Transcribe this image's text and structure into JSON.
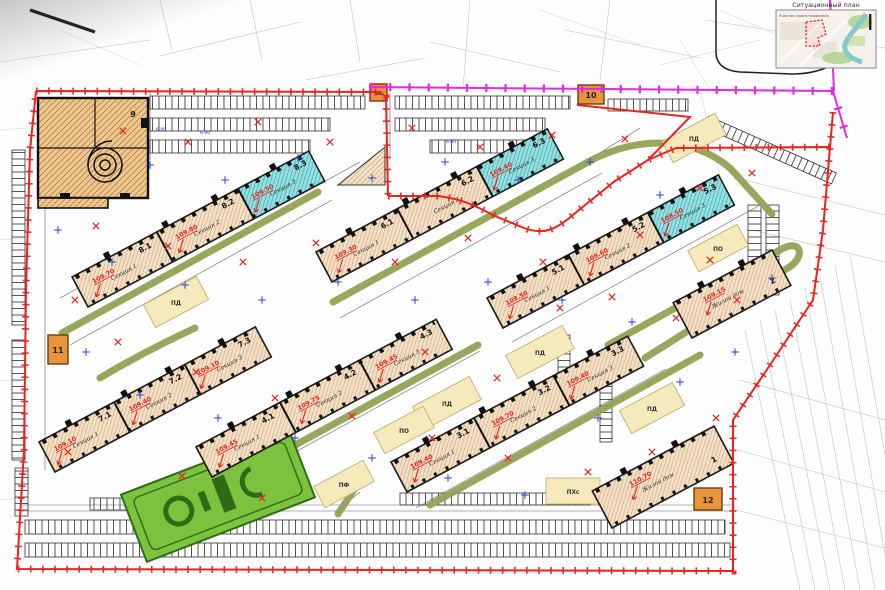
{
  "inset": {
    "title": "Ситуационный план",
    "caption": "Участок проектирования"
  },
  "buildings": [
    {
      "id": "8",
      "sections": [
        {
          "num": "8.1",
          "name": "Секция 1",
          "elev": "109.70"
        },
        {
          "num": "8.2",
          "name": "Секция 2",
          "elev": "109.80"
        },
        {
          "num": "8.3",
          "name": "Секция 3",
          "elev": "109.50"
        }
      ]
    },
    {
      "id": "6",
      "sections": [
        {
          "num": "6.1",
          "name": "Секция 1",
          "elev": "109.30"
        },
        {
          "num": "6.2",
          "name": "Секция 2",
          "elev": ""
        },
        {
          "num": "6.3",
          "name": "Секция 3",
          "elev": "109.40"
        }
      ]
    },
    {
      "id": "5",
      "sections": [
        {
          "num": "5.1",
          "name": "Секция 1",
          "elev": "109.50"
        },
        {
          "num": "5.2",
          "name": "Секция 2",
          "elev": "109.60"
        },
        {
          "num": "5.3",
          "name": "Секция 3",
          "elev": "109.50"
        }
      ]
    },
    {
      "id": "7",
      "sections": [
        {
          "num": "7.1",
          "name": "Секция 1",
          "elev": "109.10"
        },
        {
          "num": "7.2",
          "name": "Секция 2",
          "elev": "109.40"
        },
        {
          "num": "7.3",
          "name": "Секция 3",
          "elev": "109.10"
        }
      ]
    },
    {
      "id": "4",
      "sections": [
        {
          "num": "4.1",
          "name": "Секция 1",
          "elev": "109.45"
        },
        {
          "num": "4.2",
          "name": "Секция 2",
          "elev": "109.75"
        },
        {
          "num": "4.3",
          "name": "Секция 3",
          "elev": "109.45"
        }
      ]
    },
    {
      "id": "3",
      "sections": [
        {
          "num": "3.1",
          "name": "Секция 1",
          "elev": "109.40"
        },
        {
          "num": "3.2",
          "name": "Секция 2",
          "elev": "109.70"
        },
        {
          "num": "3.3",
          "name": "Секция 3",
          "elev": "109.40"
        }
      ]
    },
    {
      "id": "2",
      "sections": [
        {
          "num": "2",
          "name": "Жилой дом",
          "elev": "109.15"
        }
      ]
    },
    {
      "id": "1",
      "sections": [
        {
          "num": "1",
          "name": "Жилой дом",
          "elev": "110.70"
        }
      ]
    }
  ],
  "structures": {
    "garage": "9",
    "sub_top": "10",
    "sub_left": "11",
    "sub_bottom": "12",
    "pump": "ВС"
  },
  "playgrounds": {
    "pd": "ПД",
    "po": "ПО",
    "pf": "ПФ",
    "phs": "ПХс"
  },
  "dims": {
    "a": "6.00"
  },
  "colors": {
    "boundary": "#e8241f",
    "utility": "#e32ae3",
    "driveway": "#93a155",
    "building_fill": "#f2e0c8",
    "corner_section": "#9adfe0",
    "substation": "#e8943c",
    "field": "#7cc23e"
  }
}
